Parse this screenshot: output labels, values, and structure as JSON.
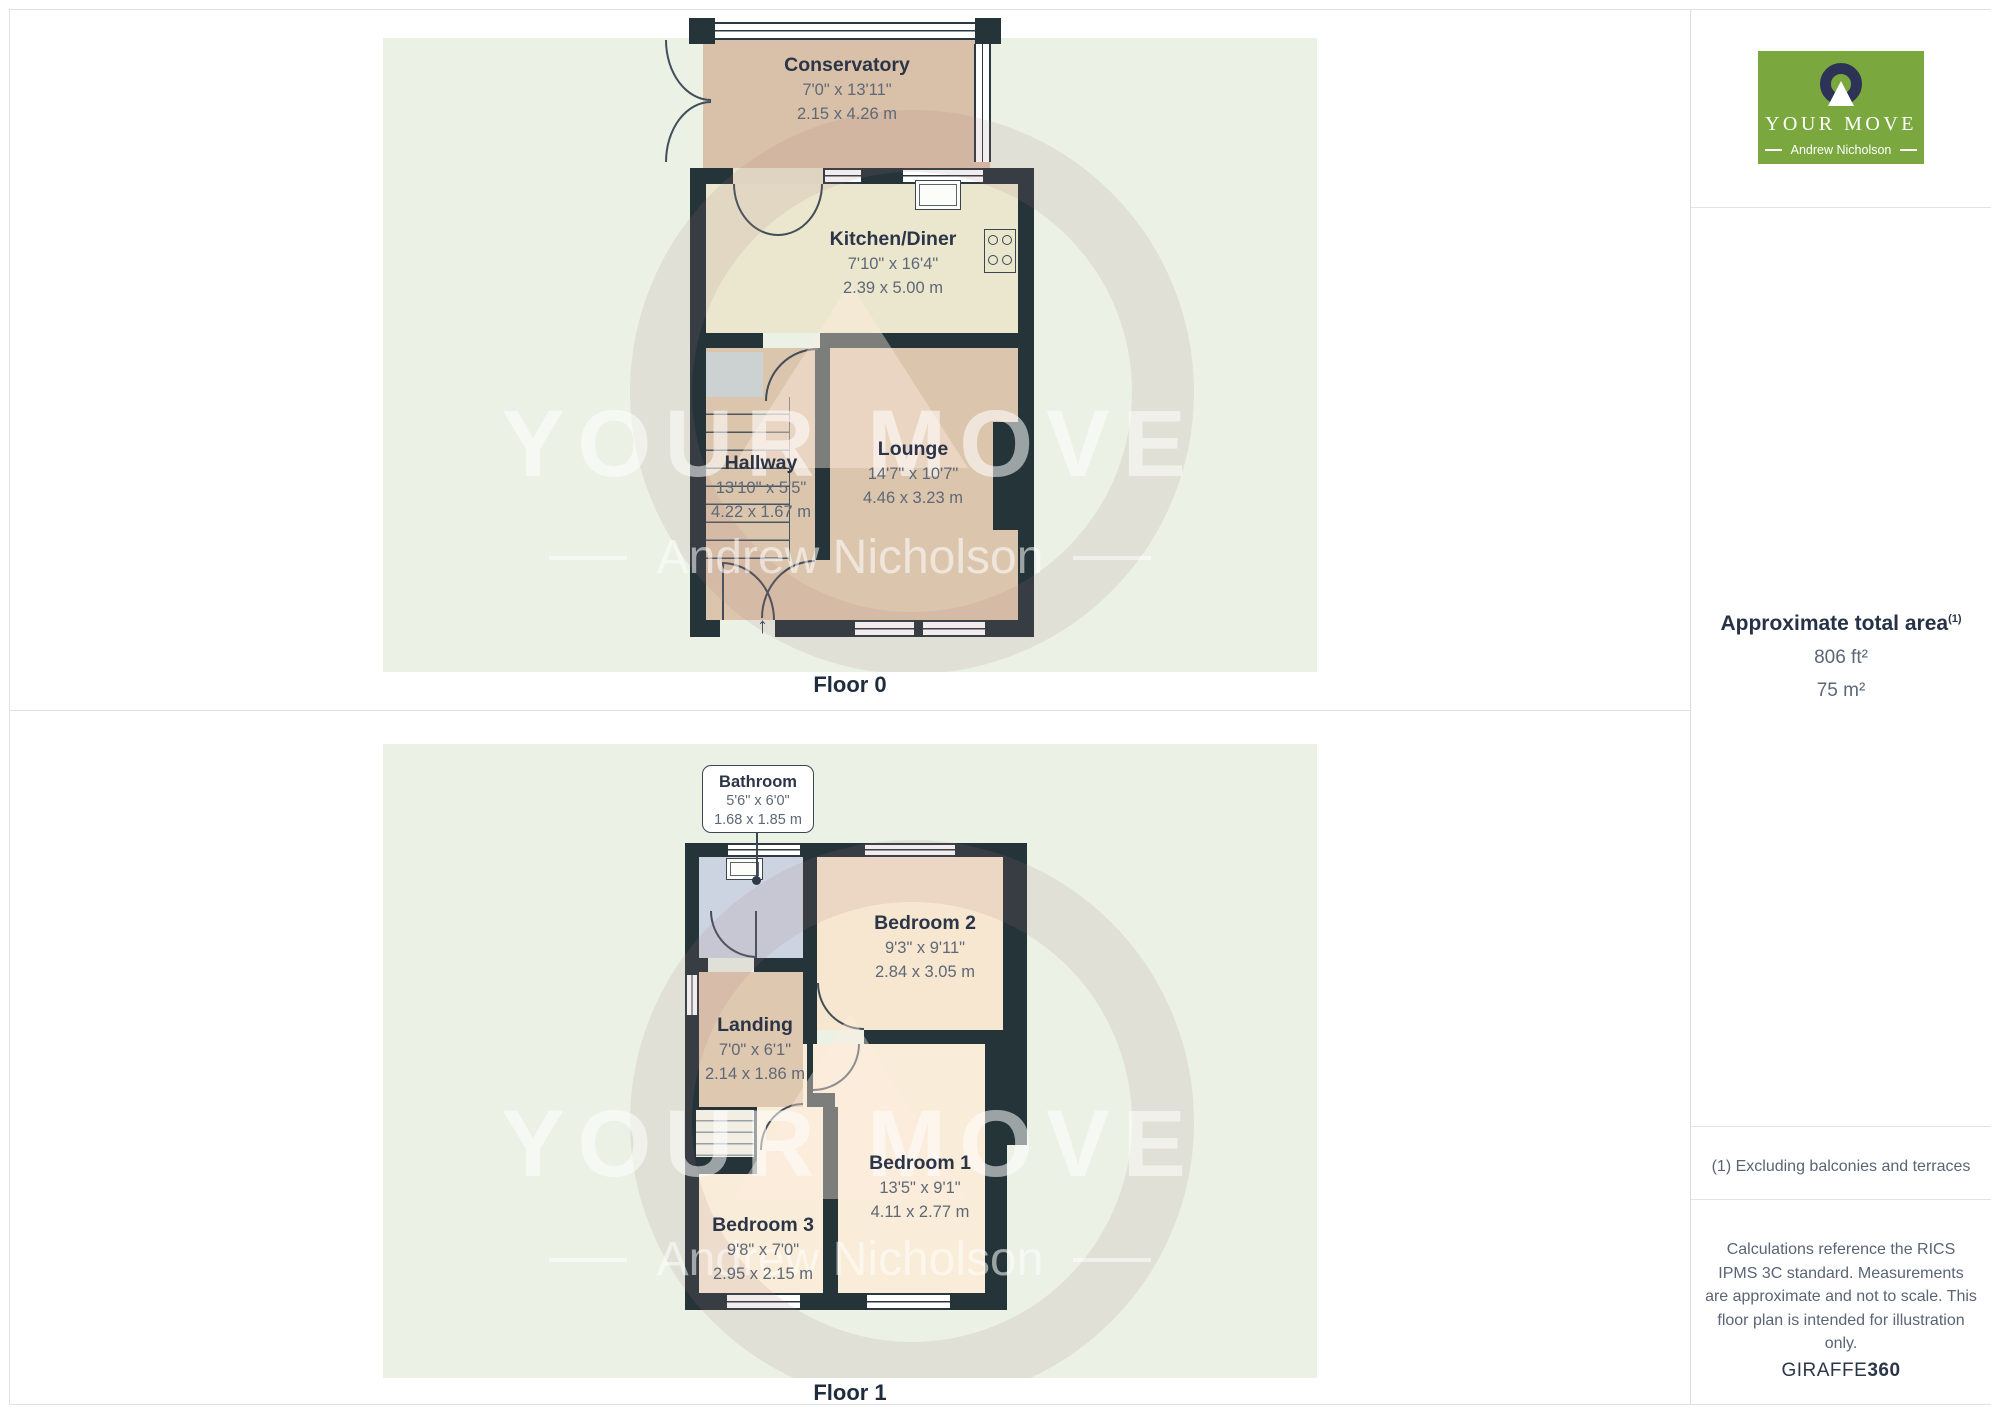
{
  "floors": [
    {
      "label": "Floor 0",
      "rooms": [
        {
          "name": "Conservatory",
          "imperial": "7'0\" x 13'11\"",
          "metric": "2.15 x 4.26 m"
        },
        {
          "name": "Kitchen/Diner",
          "imperial": "7'10\" x 16'4\"",
          "metric": "2.39 x 5.00 m"
        },
        {
          "name": "Hallway",
          "imperial": "13'10\" x 5'5\"",
          "metric": "4.22 x 1.67 m"
        },
        {
          "name": "Lounge",
          "imperial": "14'7\" x 10'7\"",
          "metric": "4.46 x 3.23 m"
        }
      ]
    },
    {
      "label": "Floor 1",
      "rooms": [
        {
          "name": "Bathroom",
          "imperial": "5'6\" x 6'0\"",
          "metric": "1.68 x 1.85 m"
        },
        {
          "name": "Bedroom 2",
          "imperial": "9'3\" x 9'11\"",
          "metric": "2.84 x 3.05 m"
        },
        {
          "name": "Landing",
          "imperial": "7'0\" x 6'1\"",
          "metric": "2.14 x 1.86 m"
        },
        {
          "name": "Bedroom 1",
          "imperial": "13'5\" x 9'1\"",
          "metric": "4.11 x 2.77 m"
        },
        {
          "name": "Bedroom 3",
          "imperial": "9'8\" x 7'0\"",
          "metric": "2.95 x 2.15 m"
        }
      ]
    }
  ],
  "watermark": {
    "title": "YOUR MOVE",
    "subtitle": "Andrew Nicholson"
  },
  "sidebar": {
    "logo": {
      "brand": "YOUR MOVE",
      "agent": "Andrew Nicholson",
      "green": "#7aa83e",
      "navy": "#2c3357"
    },
    "area": {
      "heading": "Approximate total area",
      "footnote_marker": "(1)",
      "imperial": "806 ft²",
      "metric": "75 m²"
    },
    "footnote": "(1) Excluding balconies and terraces",
    "disclaimer": "Calculations reference the RICS IPMS 3C standard. Measurements are approximate and not to scale. This floor plan is intended for illustration only.",
    "brand_footer": {
      "name": "GIRAFFE",
      "suffix": "360"
    }
  },
  "colors": {
    "wall": "#253439",
    "panel": "#ebf1e5",
    "conservatory": "#d9c0a8",
    "kitchen": "#ebe7ce",
    "tan_room": "#dcc5ad",
    "bedroom": "#f9ecd8",
    "bathroom": "#ccd3e1"
  }
}
